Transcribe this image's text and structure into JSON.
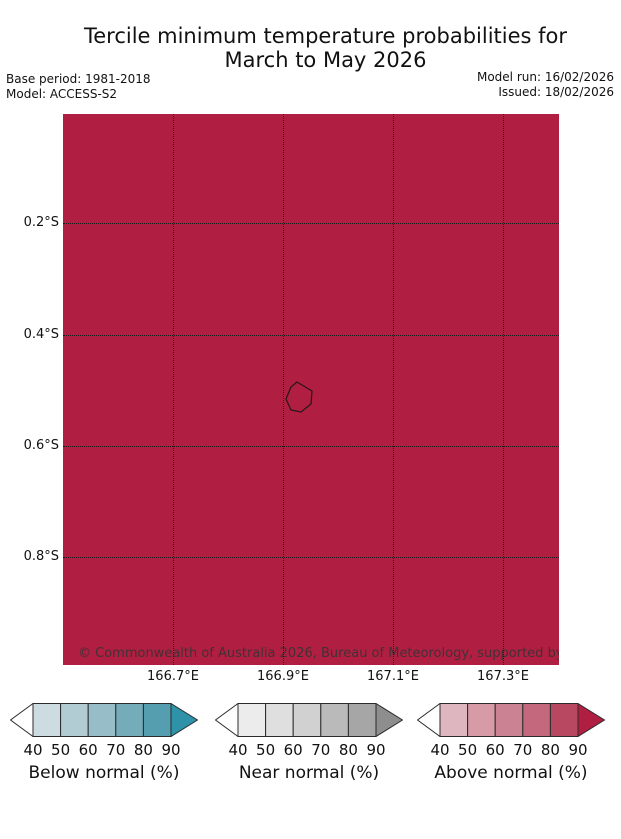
{
  "header": {
    "title_line1": "Tercile minimum temperature probabilities for",
    "title_line2": "March to May 2026",
    "base_period": "Base period: 1981-2018",
    "model": "Model: ACCESS-S2",
    "model_run": "Model run: 16/02/2026",
    "issued": "Issued: 18/02/2026"
  },
  "map": {
    "fill_color": "#b01f41",
    "grid_color": "#1a1a1a",
    "copyright": "© Commonwealth of Australia 2026, Bureau of Meteorology, supported by COSPPac",
    "island_outline_color": "#2e141d",
    "island_points": [
      [
        234,
        268
      ],
      [
        249,
        277
      ],
      [
        248,
        290
      ],
      [
        238,
        298
      ],
      [
        228,
        296
      ],
      [
        223,
        285
      ],
      [
        228,
        273
      ]
    ]
  },
  "chart_data": {
    "type": "heatmap",
    "title": "Tercile minimum temperature probabilities for March to May 2026",
    "region": "Nauru",
    "map_fill_category": "Above normal, highest class (>90%)",
    "map_fill_color": "#b01f41",
    "x_ticks": [
      {
        "label": "166.7°E",
        "frac": 0.2218
      },
      {
        "label": "166.9°E",
        "frac": 0.4435
      },
      {
        "label": "167.1°E",
        "frac": 0.6653
      },
      {
        "label": "167.3°E",
        "frac": 0.8871
      }
    ],
    "y_ticks": [
      {
        "label": "0.2°S",
        "frac": 0.1978
      },
      {
        "label": "0.4°S",
        "frac": 0.4002
      },
      {
        "label": "0.6°S",
        "frac": 0.6025
      },
      {
        "label": "0.8°S",
        "frac": 0.804
      }
    ],
    "legend_position": "bottom",
    "grid": "dotted"
  },
  "colorbars": [
    {
      "label": "Below normal (%)",
      "ticks": [
        "40",
        "50",
        "60",
        "70",
        "80",
        "90"
      ],
      "segment_colors": [
        "#cddce1",
        "#b2ccd3",
        "#96bdc8",
        "#74acba",
        "#549eb0"
      ],
      "arrow_left_color": "#ffffff",
      "arrow_right_color": "#2e93a9"
    },
    {
      "label": "Near normal (%)",
      "ticks": [
        "40",
        "50",
        "60",
        "70",
        "80",
        "90"
      ],
      "segment_colors": [
        "#ececec",
        "#dfdfdf",
        "#d1d1d1",
        "#bababa",
        "#a6a6a6"
      ],
      "arrow_left_color": "#ffffff",
      "arrow_right_color": "#8e8e8e"
    },
    {
      "label": "Above normal (%)",
      "ticks": [
        "40",
        "50",
        "60",
        "70",
        "80",
        "90"
      ],
      "segment_colors": [
        "#ddb6c0",
        "#d79aa7",
        "#cb8292",
        "#c4697d",
        "#b84861"
      ],
      "arrow_left_color": "#ffffff",
      "arrow_right_color": "#b01f41"
    }
  ]
}
